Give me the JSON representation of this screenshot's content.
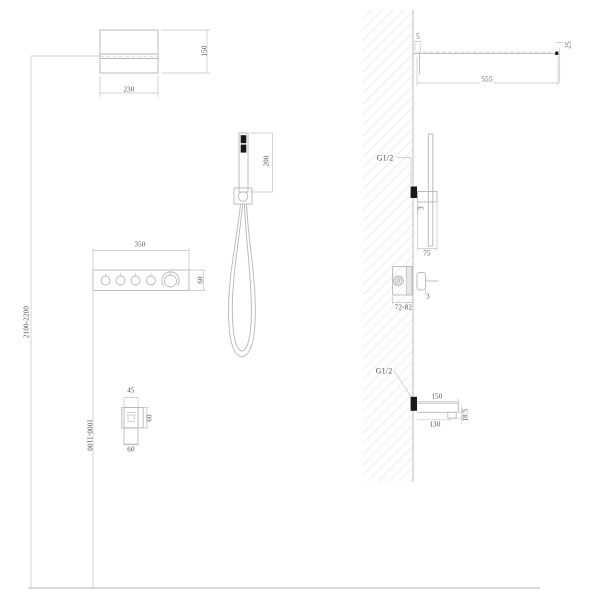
{
  "front": {
    "head_width": "230",
    "head_height": "150",
    "handshower_length": "200",
    "panel_width": "350",
    "panel_height": "60",
    "mount_height_head": "2100-2200",
    "mount_height_panel": "1000-1100",
    "valve_width": "45",
    "valve_height": "60",
    "valve_size": "60"
  },
  "side": {
    "arm_plate_offset": "5",
    "arm_end_size": "25",
    "arm_length": "555",
    "thread_upper": "G1/2",
    "holder_gap": "3",
    "holder_depth": "75",
    "mixer_depth_range": "72-82",
    "handle_gap": "3",
    "thread_lower": "G1/2",
    "spout_length_top": "150",
    "spout_length_bottom": "130",
    "spout_end_height": "18.5"
  },
  "colors": {
    "line": "#b6b6b6",
    "thin": "#c3c3c3",
    "text": "#4f4f4f",
    "ink": "#191919",
    "hatch": "#dadada"
  }
}
